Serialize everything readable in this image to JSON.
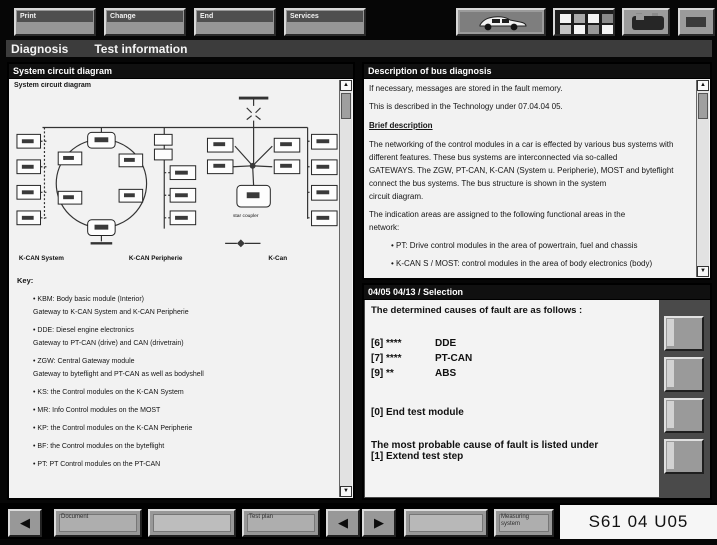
{
  "colors": {
    "background": "#040404",
    "panel": "#f2f2f2",
    "panel_header": "#101010",
    "button": "#989898",
    "title_bar": "#3c3c3c"
  },
  "glyphs": {
    "back": "◀",
    "forward": "▶",
    "scroll_up": "▲",
    "scroll_down": "▼"
  },
  "icons": {
    "top_status": [
      "car-icon",
      "keypad-icon",
      "battery-icon",
      "panel-icon"
    ]
  },
  "top_toolbar": {
    "buttons": [
      {
        "label": "Print"
      },
      {
        "label": "Change"
      },
      {
        "label": "End"
      },
      {
        "label": "Services"
      }
    ]
  },
  "title_bar": {
    "app": "Diagnosis",
    "screen": "Test information"
  },
  "left_panel": {
    "header": "System circuit diagram",
    "caption": "System circuit diagram",
    "diagram": {
      "bus_labels": [
        "K-CAN System",
        "K-CAN Peripherie",
        "K-Can"
      ],
      "star_caption": "star coupler"
    },
    "key_heading": "Key:",
    "key_pairs": [
      {
        "line1": "• KBM: Body basic module (Interior)",
        "line2": "Gateway to K-CAN System and K-CAN Peripherie"
      },
      {
        "line1": "• DDE: Diesel engine electronics",
        "line2": "Gateway to PT-CAN (drive) and CAN (drivetrain)"
      },
      {
        "line1": "• ZGW: Central Gateway module",
        "line2": "Gateway to byteflight and PT-CAN as well as bodyshell"
      }
    ],
    "key_singles": [
      "• KS: the Control modules on the K-CAN System",
      "• MR: Info Control modules on the MOST",
      "• KP: the Control modules on the K-CAN Peripherie",
      "• BF: the Control modules on the byteflight",
      "• PT: PT Control modules on the PT-CAN"
    ]
  },
  "right_top_panel": {
    "header": "Description of bus diagnosis",
    "intro_lines": [
      "If necessary, messages are stored in the fault memory.",
      "This is described in the Technology under 07.04.04 05."
    ],
    "brief_heading": "Brief description",
    "body_lines": [
      "The networking of the control modules in a car is effected by various bus systems with",
      "different features. These bus systems are interconnected via so-called",
      "GATEWAYS. The ZGW, PT-CAN, K-CAN (System u. Peripherie), MOST and byteflight",
      "connect the bus systems. The bus structure is shown in the system",
      "circuit diagram."
    ],
    "assignment_lines": [
      "The indication areas are assigned to the following functional areas in the",
      "network:"
    ],
    "bullets": [
      "• PT: Drive control modules in the area of powertrain, fuel and chassis",
      "• K-CAN S / MOST: control modules in the area of body electronics (body)"
    ]
  },
  "right_bottom_panel": {
    "header": "04/05 04/13 / Selection",
    "intro": "The determined causes of fault are as follows :",
    "causes": [
      {
        "code": "[6] ****",
        "label": "DDE"
      },
      {
        "code": "[7] ****",
        "label": "PT-CAN"
      },
      {
        "code": "[9] **",
        "label": "ABS"
      }
    ],
    "end_line": "[0] End test module",
    "probable_line": "The most probable cause of fault is listed under",
    "extend_line": "[1] Extend test step"
  },
  "bottom_toolbar": {
    "buttons": [
      {
        "label": "Document"
      },
      {
        "label": ""
      },
      {
        "label": "Test plan"
      },
      {
        "label": ""
      },
      {
        "label": "Measuring system"
      }
    ],
    "doc_id": "S61 04 U05"
  }
}
